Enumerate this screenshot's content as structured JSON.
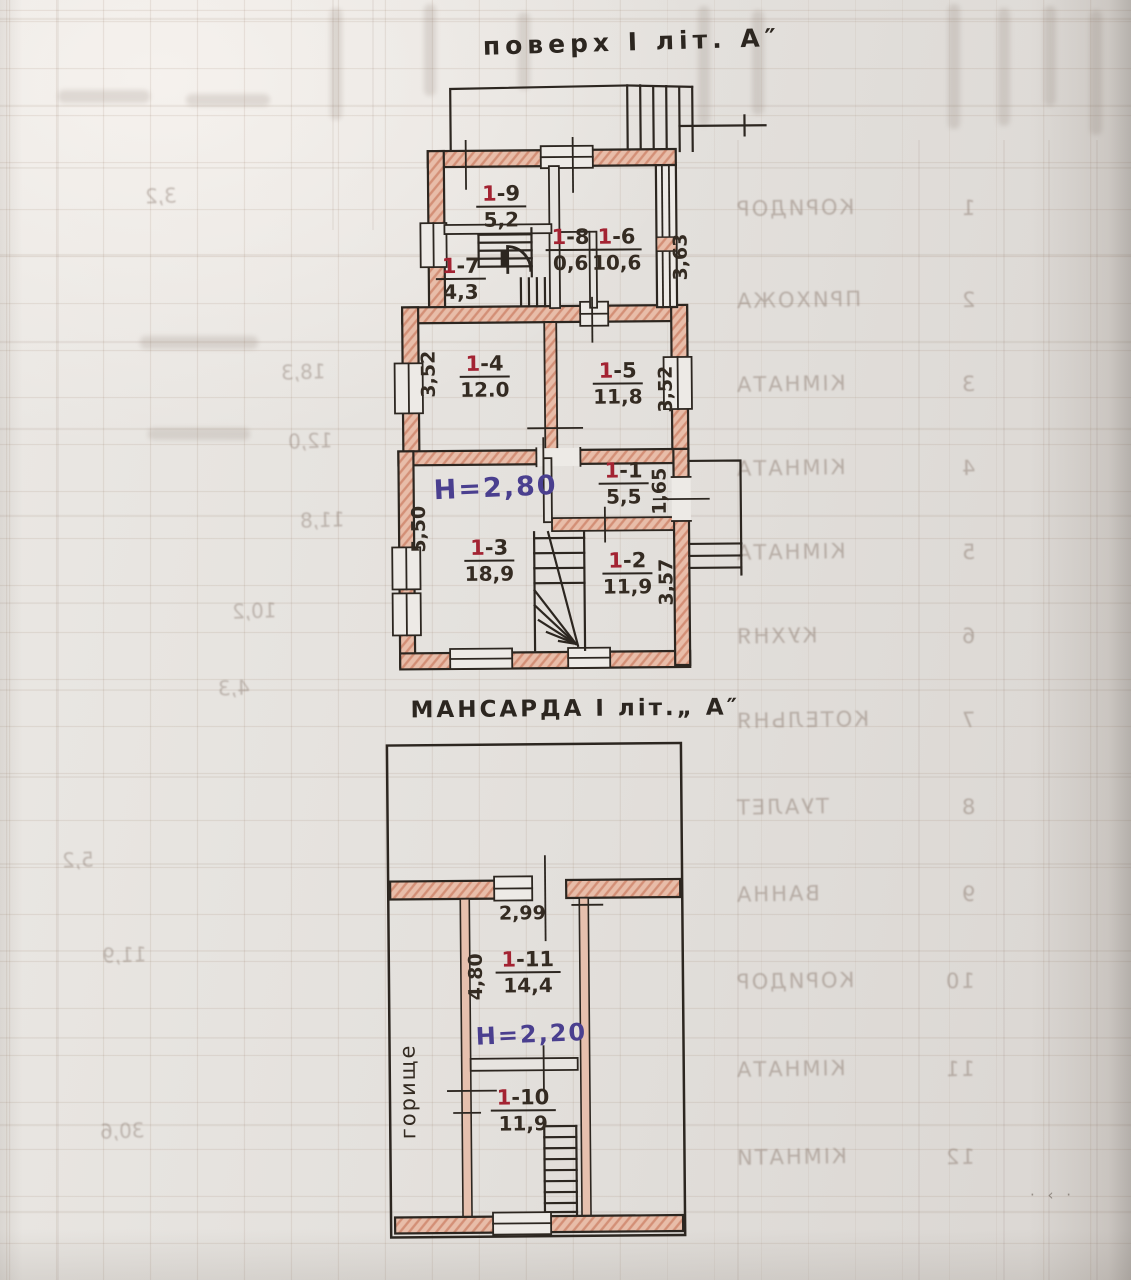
{
  "paper": {
    "background": "#e4e1dd",
    "ink": "#2c2620",
    "wall_pink": "#e8bda9",
    "room_number_red": "#a32332",
    "height_blue": "#4a3f8f"
  },
  "floor1": {
    "title": "поверх I літ. А″",
    "height_label": "H=2,80",
    "rooms": {
      "r1": {
        "num": "1",
        "suf": "-1",
        "area": "5,5"
      },
      "r2": {
        "num": "1",
        "suf": "-2",
        "area": "11,9"
      },
      "r3": {
        "num": "1",
        "suf": "-3",
        "area": "18,9"
      },
      "r4": {
        "num": "1",
        "suf": "-4",
        "area": "12.0"
      },
      "r5": {
        "num": "1",
        "suf": "-5",
        "area": "11,8"
      },
      "r6": {
        "num": "1",
        "suf": "-6",
        "area": "10,6"
      },
      "r7": {
        "num": "1",
        "suf": "-7",
        "area": "4,3"
      },
      "r8": {
        "num": "1",
        "suf": "-8",
        "area": "0,6"
      },
      "r9": {
        "num": "1",
        "suf": "-9",
        "area": "5,2"
      }
    },
    "dims": {
      "right_1_6": "3,63",
      "left_1_4": "3,52",
      "right_1_5": "3,52",
      "left_1_3": "5,50",
      "right_1_1": "1,65",
      "right_1_2": "3,57"
    }
  },
  "attic": {
    "title": "МАНСАРДА I літ.„ А″",
    "height_label": "H=2,20",
    "side_label": "горище",
    "rooms": {
      "r10": {
        "num": "1",
        "suf": "-10",
        "area": "11,9"
      },
      "r11": {
        "num": "1",
        "suf": "-11",
        "area": "14,4"
      }
    },
    "dims": {
      "top_width": "2,99",
      "left_1_11": "4,80"
    }
  },
  "bleedthrough": {
    "right_rows": [
      {
        "no": "1",
        "label": "КОРИДОР"
      },
      {
        "no": "2",
        "label": "ПРИХОЖА"
      },
      {
        "no": "3",
        "label": "КІМНАТА"
      },
      {
        "no": "4",
        "label": "КІМНАТА"
      },
      {
        "no": "5",
        "label": "КІМНАТА"
      },
      {
        "no": "6",
        "label": "КУХНЯ"
      },
      {
        "no": "7",
        "label": "КОТЕЛЬНЯ"
      },
      {
        "no": "8",
        "label": "ТУАЛЕТ"
      },
      {
        "no": "9",
        "label": "ВАННА"
      },
      {
        "no": "10",
        "label": "КОРИДОР"
      },
      {
        "no": "11",
        "label": "КІМНАТА"
      },
      {
        "no": "12",
        "label": "КІМНАТИ"
      }
    ],
    "left_numbers": [
      {
        "value": "3,2"
      },
      {
        "value": "18,3"
      },
      {
        "value": "12,0"
      },
      {
        "value": "11,8"
      },
      {
        "value": "10,2"
      },
      {
        "value": "4,3"
      },
      {
        "value": "5,2"
      },
      {
        "value": "11,9"
      },
      {
        "value": "30,6"
      }
    ],
    "corner_mark": "· ‹ ·"
  }
}
